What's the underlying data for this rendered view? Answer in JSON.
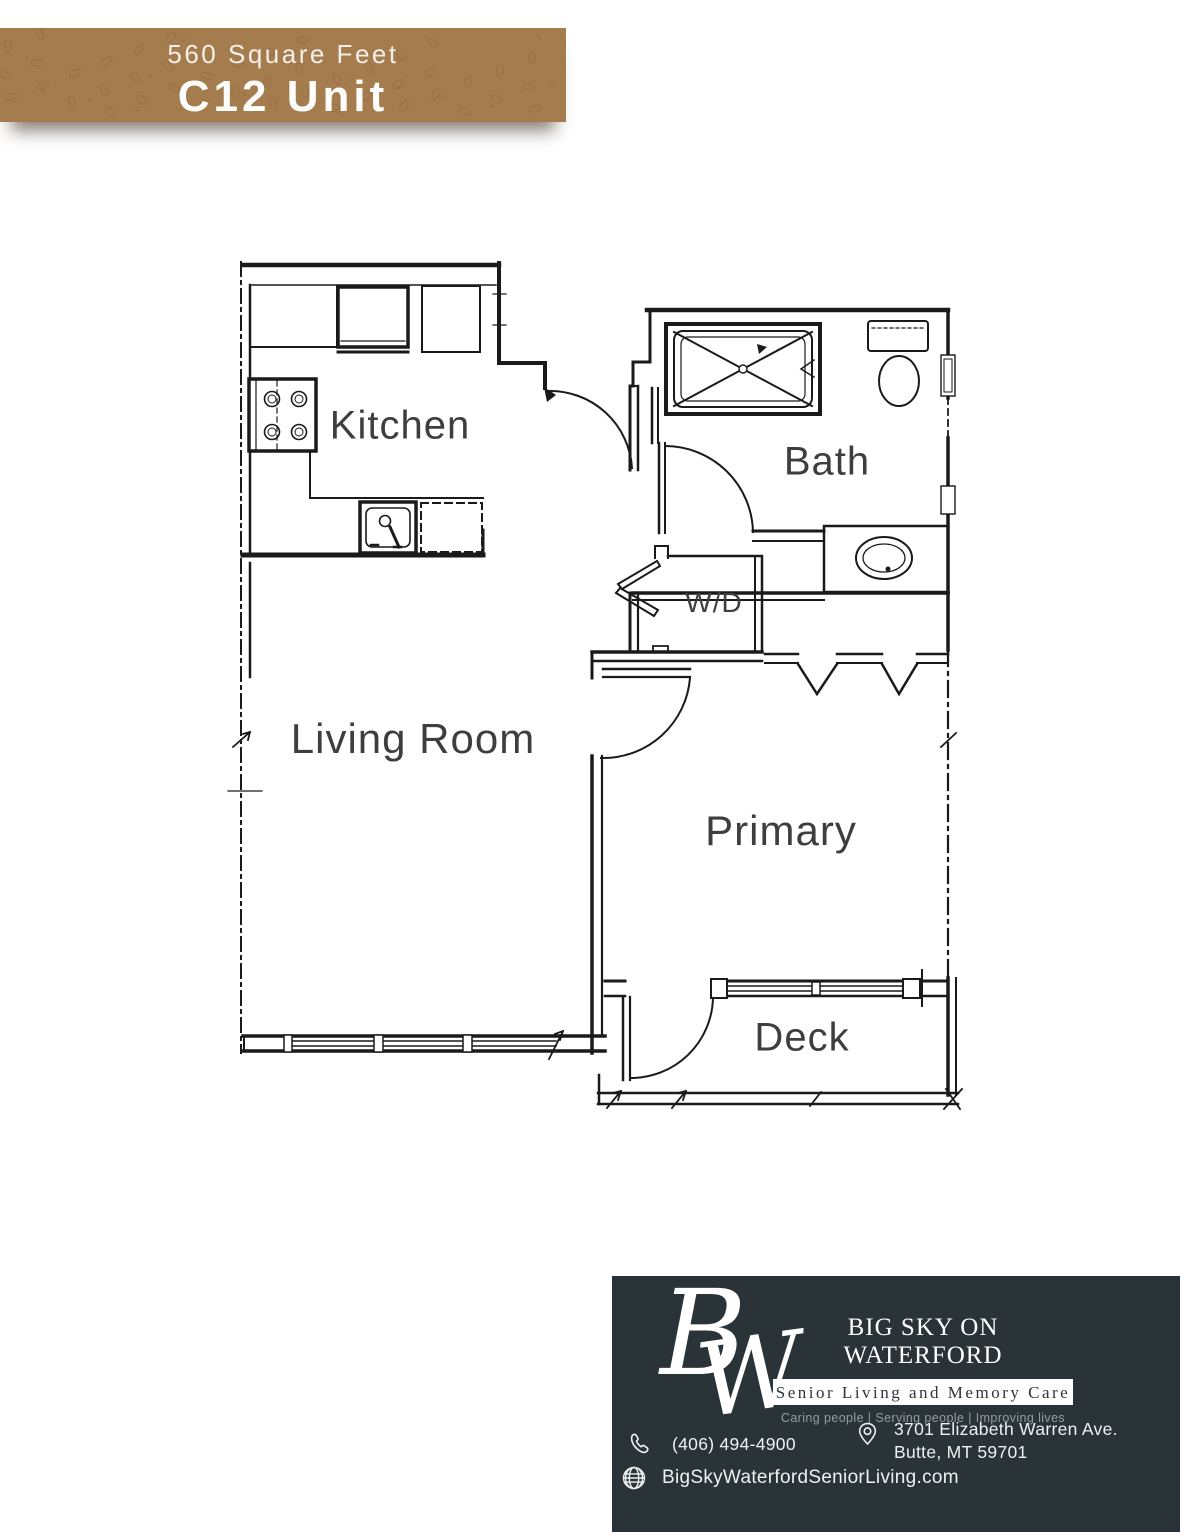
{
  "header": {
    "subtitle": "560 Square Feet",
    "title": "C12 Unit"
  },
  "floorplan": {
    "labels": {
      "kitchen": "Kitchen",
      "bath": "Bath",
      "washer_dryer": "W/D",
      "living_room": "Living Room",
      "primary": "Primary",
      "deck": "Deck"
    }
  },
  "footer": {
    "monogram": {
      "letter_b": "B",
      "letter_w": "W"
    },
    "brand_name": "BIG SKY ON WATERFORD",
    "division": "Senior Living and Memory Care",
    "tagline": "Caring people |  Serving people  |  Improving lives",
    "phone": "(406) 494-4900",
    "address_line1": "3701 Elizabeth Warren Ave.",
    "address_line2": "Butte, MT 59701",
    "website": "BigSkyWaterfordSeniorLiving.com"
  },
  "colors": {
    "banner": "#a57c4e",
    "banner_pattern": "#8f6940",
    "footer_bg": "#2a3338",
    "plan_line": "#1a1a1a",
    "label_text": "#3e3e3e"
  }
}
